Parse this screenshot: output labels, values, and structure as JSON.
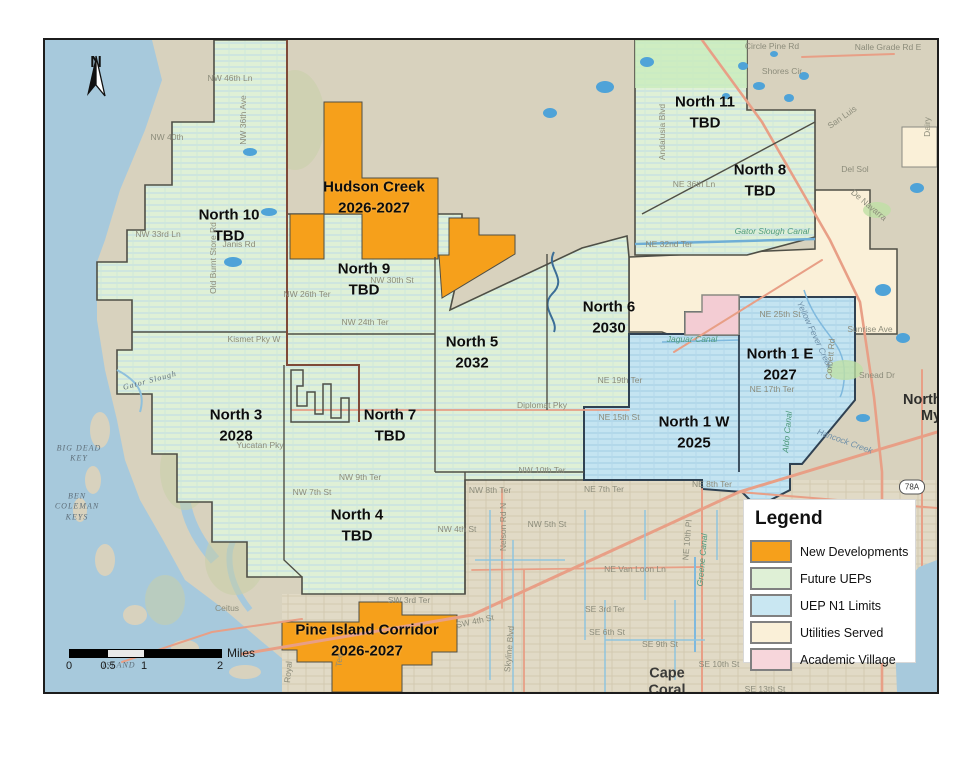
{
  "map": {
    "compass_letter": "N",
    "zones": [
      {
        "name": "North 10",
        "year": "TBD"
      },
      {
        "name": "Hudson Creek",
        "year": "2026-2027"
      },
      {
        "name": "North 9",
        "year": "TBD"
      },
      {
        "name": "North 11",
        "year": "TBD"
      },
      {
        "name": "North 8",
        "year": "TBD"
      },
      {
        "name": "North 6",
        "year": "2030"
      },
      {
        "name": "North 5",
        "year": "2032"
      },
      {
        "name": "North 1 E",
        "year": "2027"
      },
      {
        "name": "North 1 W",
        "year": "2025"
      },
      {
        "name": "North 3",
        "year": "2028"
      },
      {
        "name": "North 7",
        "year": "TBD"
      },
      {
        "name": "North 4",
        "year": "TBD"
      },
      {
        "name": "Pine Island Corridor",
        "year": "2026-2027"
      }
    ],
    "places": [
      "NW 46th Ln",
      "NW 40th",
      "NW 33rd Ln",
      "Janis Rd",
      "Old Burnt Store Rd",
      "NW 36th Ave",
      "NW 30th St",
      "NW 26th Ter",
      "NW 24th Ter",
      "Kismet Pky W",
      "Gator Slough",
      "Yucatan Pky",
      "NW 9th Ter",
      "NW 7th St",
      "NW 8th Ter",
      "NE 7th Ter",
      "NE 8th Ter",
      "NE 19th Ter",
      "NE 15th St",
      "Diplomat Pky",
      "NW 10th Ter",
      "NW 5th St",
      "NW 4th St",
      "Nelson Rd N",
      "NE Van Loon Ln",
      "SE 3rd Ter",
      "SE 6th St",
      "SE 9th St",
      "SE 10th St",
      "SE 13th St",
      "Greene Canal",
      "NE 10th Pl",
      "Skyline Blvd",
      "SW 3rd Ter",
      "SW 4th St",
      "Tee",
      "Royal",
      "Ceitus",
      "WEST\nISLAND",
      "BIG DEAD\nKEY",
      "BEN\nCOLEMAN\nKEYS",
      "Circle Pine Rd",
      "Nalle Grade Rd E",
      "Shores Cir",
      "Andalusia Blvd",
      "San Luis",
      "Del Sol",
      "NE 36th Ln",
      "NE 32nd Ter",
      "Gator Slough Canal",
      "NE 25th St",
      "NE 17th Ter",
      "Corbett Rd",
      "Yellow Fever Creek",
      "Sunrise Ave",
      "Snead Dr",
      "Hancock Creek",
      "Dairy",
      "De Navarra",
      "Aldo Canal",
      "Jaguar Canal"
    ],
    "city_label": "Cape\nCoral",
    "nfm_line1": "North",
    "nfm_line2": "Mye",
    "route_shield": "78A"
  },
  "legend": {
    "title": "Legend",
    "items": [
      {
        "label": "New Developments",
        "color": "#F6A01B"
      },
      {
        "label": "Future UEPs",
        "color": "#DFF0D6"
      },
      {
        "label": "UEP N1 Limits",
        "color": "#C9E7F2"
      },
      {
        "label": "Utilities Served",
        "color": "#FAF0D8"
      },
      {
        "label": "Academic Village",
        "color": "#F7D6DB"
      }
    ]
  },
  "scalebar": {
    "ticks": [
      "0",
      "0.5",
      "1",
      "2"
    ],
    "unit": "Miles"
  },
  "colors": {
    "water": "#A7C9DC",
    "land": "#D8D2BE",
    "roads": "#E89F86",
    "zone_border": "#4F4F46",
    "n1_border": "#2F4152",
    "new_dev": "#F6A01B"
  }
}
